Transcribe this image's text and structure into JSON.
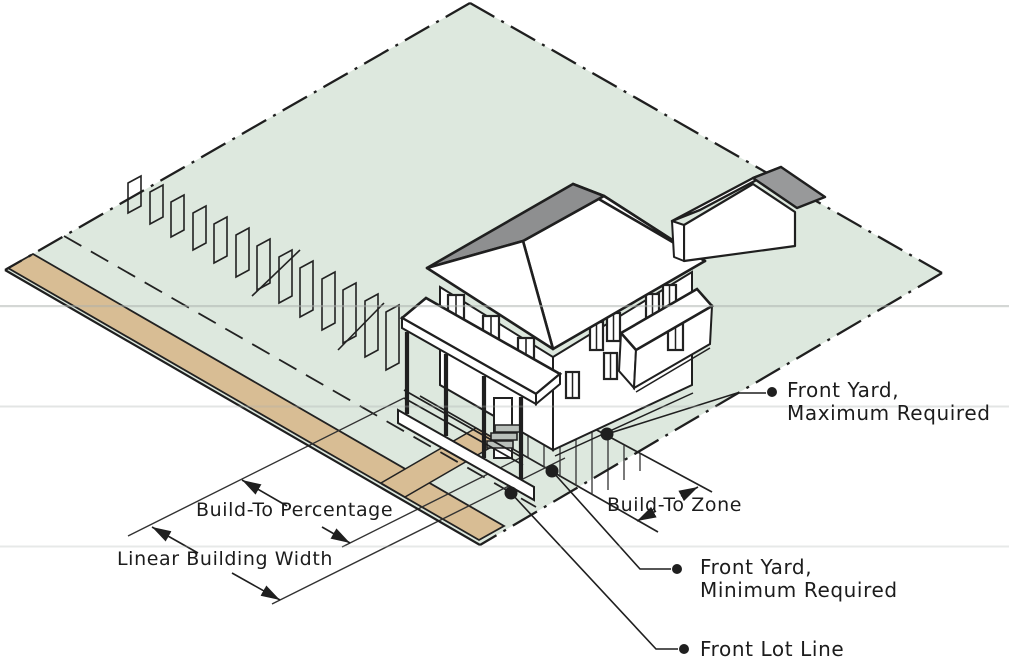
{
  "diagram": {
    "type": "zoning-isometric-lot-diagram",
    "callouts": {
      "front_yard_max": {
        "line1": "Front Yard,",
        "line2": "Maximum Required"
      },
      "front_yard_min": {
        "line1": "Front Yard,",
        "line2": "Minimum Required"
      },
      "front_lot_line": {
        "label": "Front Lot Line"
      }
    },
    "dimensions": {
      "build_to_percentage": {
        "label": "Build-To Percentage"
      },
      "linear_building_width": {
        "label": "Linear Building Width"
      },
      "build_to_zone": {
        "label": "Build-To Zone"
      }
    },
    "colors": {
      "lot_green": "#dde8de",
      "pavement_tan": "#d8bd94",
      "roof_gray": "#8e8f90",
      "garage_roof_gray": "#98999a",
      "line_dark": "#1f1f1f",
      "text": "#1c1c1c"
    }
  }
}
